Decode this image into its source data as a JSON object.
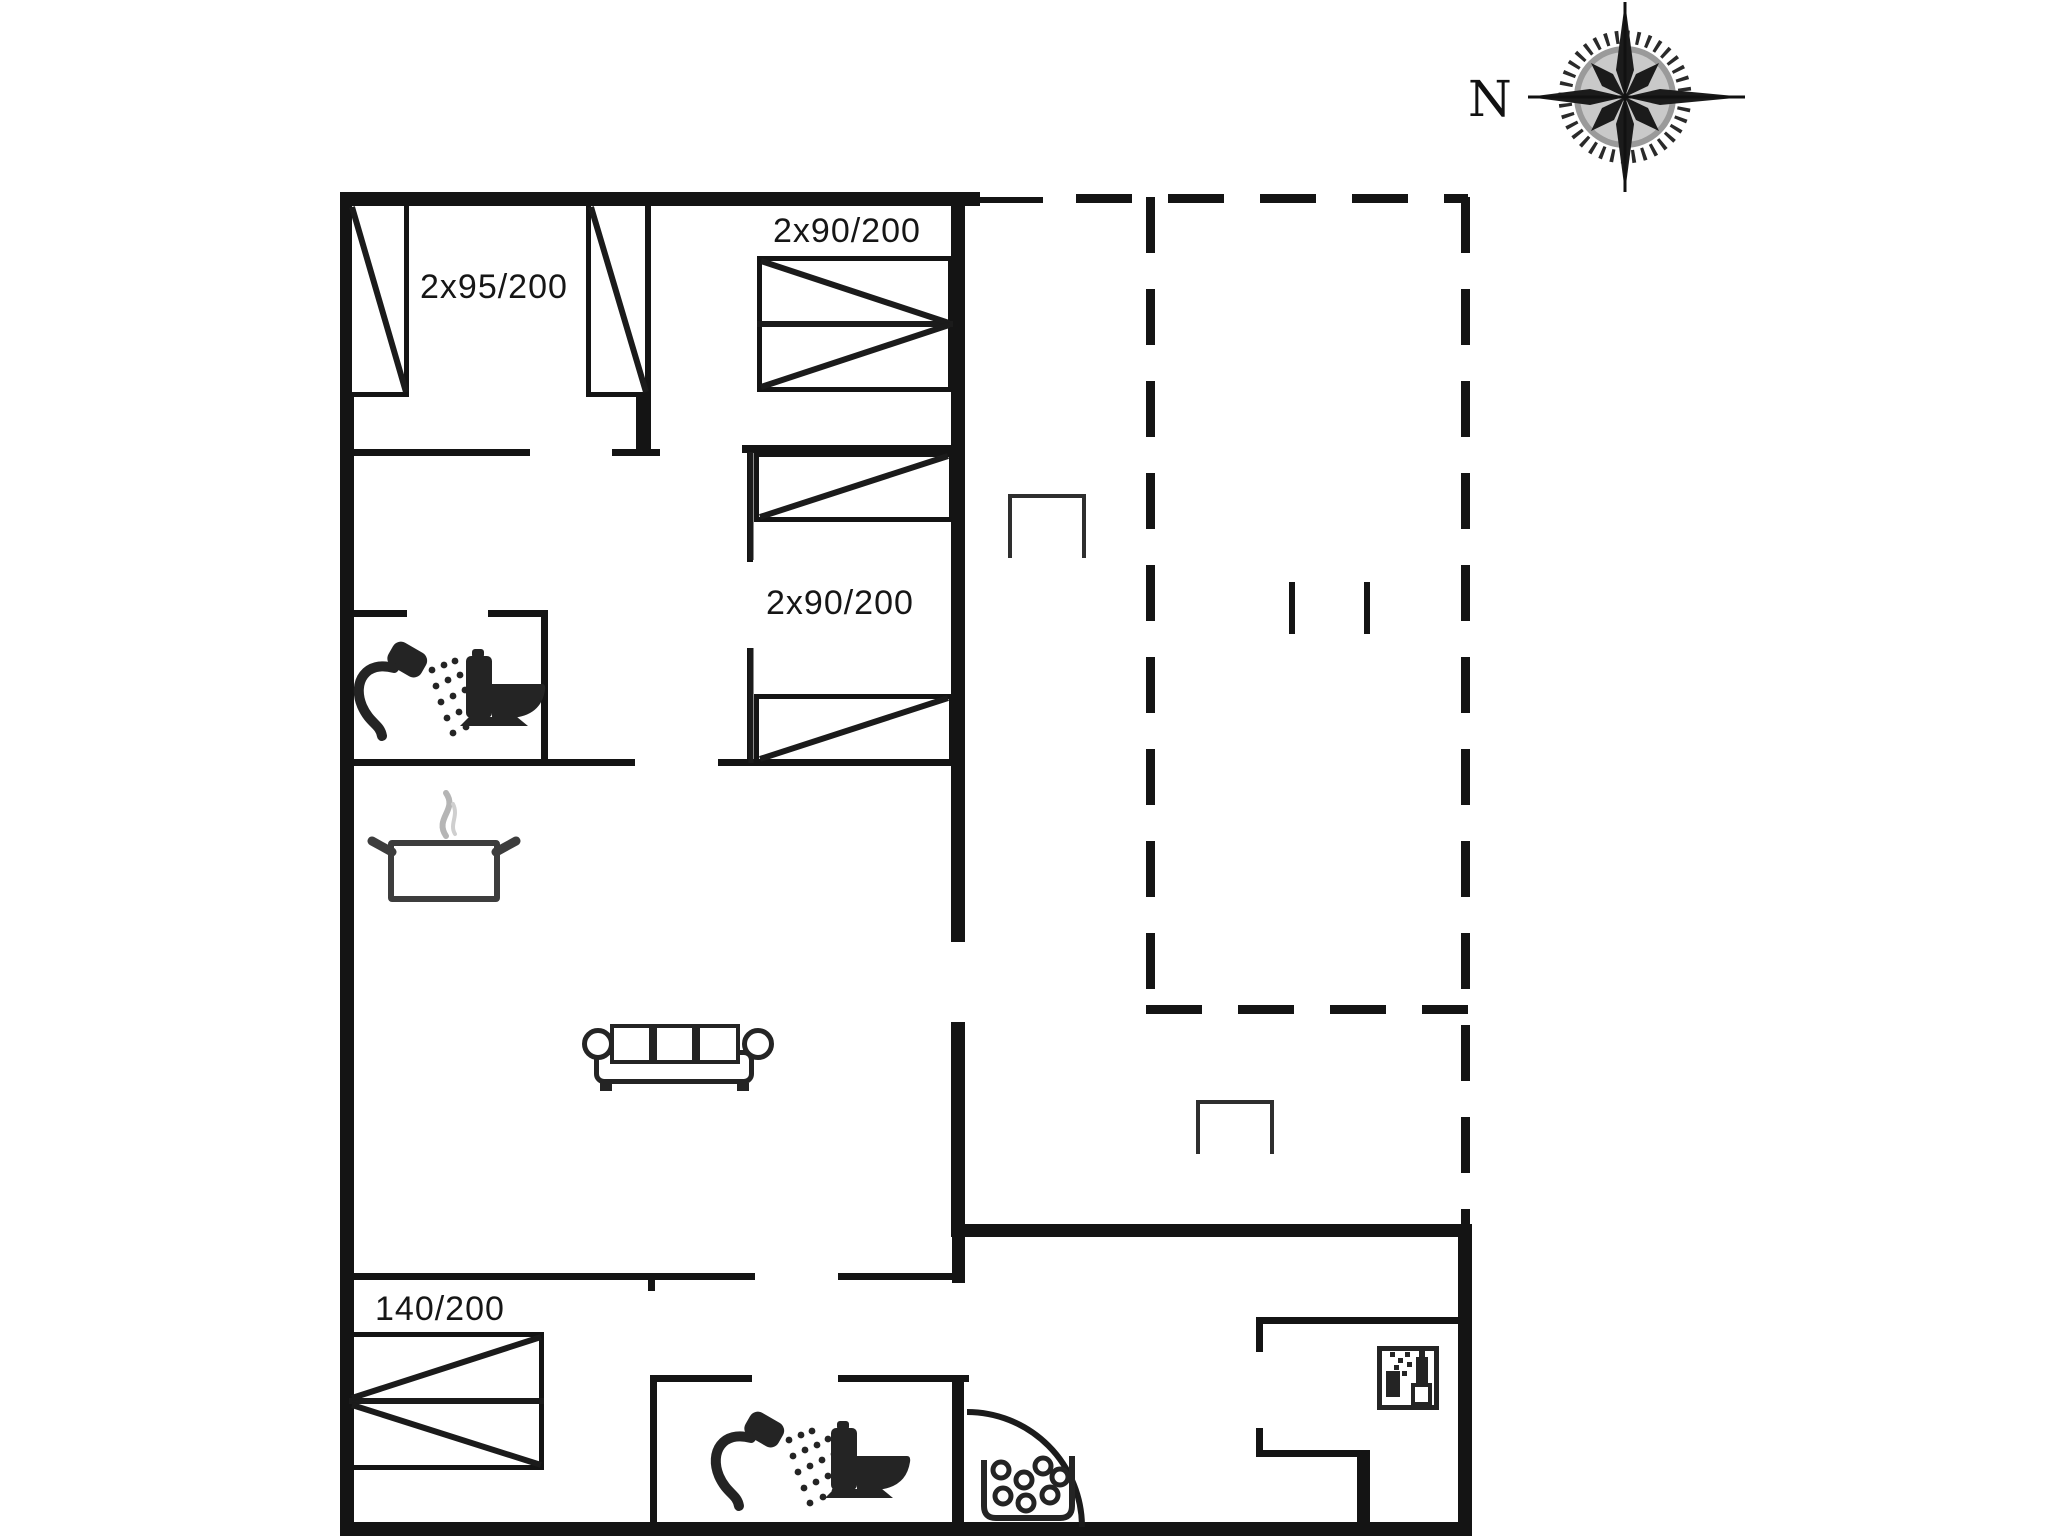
{
  "plan_title": "holiday-house-floor-plan",
  "compass": {
    "label": "N"
  },
  "labels": {
    "bedroom_top_left": "2x95/200",
    "bedroom_top_middle": "2x90/200",
    "bedroom_middle": "2x90/200",
    "bedroom_bottom_left": "140/200"
  },
  "rooms": [
    {
      "name": "bedroom-top-left",
      "bed_size": "2x95/200"
    },
    {
      "name": "bedroom-top-middle",
      "bed_size": "2x90/200"
    },
    {
      "name": "bedroom-middle",
      "bed_size": "2x90/200"
    },
    {
      "name": "bathroom-upper",
      "fixtures": [
        "shower",
        "toilet"
      ]
    },
    {
      "name": "living-room-kitchen",
      "fixtures": [
        "cooking-pot",
        "sofa"
      ]
    },
    {
      "name": "bedroom-bottom-left",
      "bed_size": "140/200"
    },
    {
      "name": "bathroom-lower",
      "fixtures": [
        "shower",
        "toilet"
      ]
    },
    {
      "name": "entrance-utility",
      "fixtures": [
        "door-swing",
        "pebble-basket",
        "dishwasher"
      ]
    },
    {
      "name": "terrace",
      "style": "dashed-outline",
      "fixtures": [
        "step-bracket",
        "step-bracket"
      ]
    }
  ],
  "icons": [
    "compass-rose-icon",
    "shower-icon",
    "toilet-icon",
    "cooking-pot-icon",
    "steam-icon",
    "sofa-icon",
    "bed-symbol",
    "door-swing-arc-icon",
    "pebble-basket-icon",
    "dishwasher-icon",
    "terrace-step-icon"
  ],
  "colors": {
    "wall": "#141414",
    "icon": "#242424",
    "steam": "#b5b5b5",
    "background": "#ffffff"
  }
}
